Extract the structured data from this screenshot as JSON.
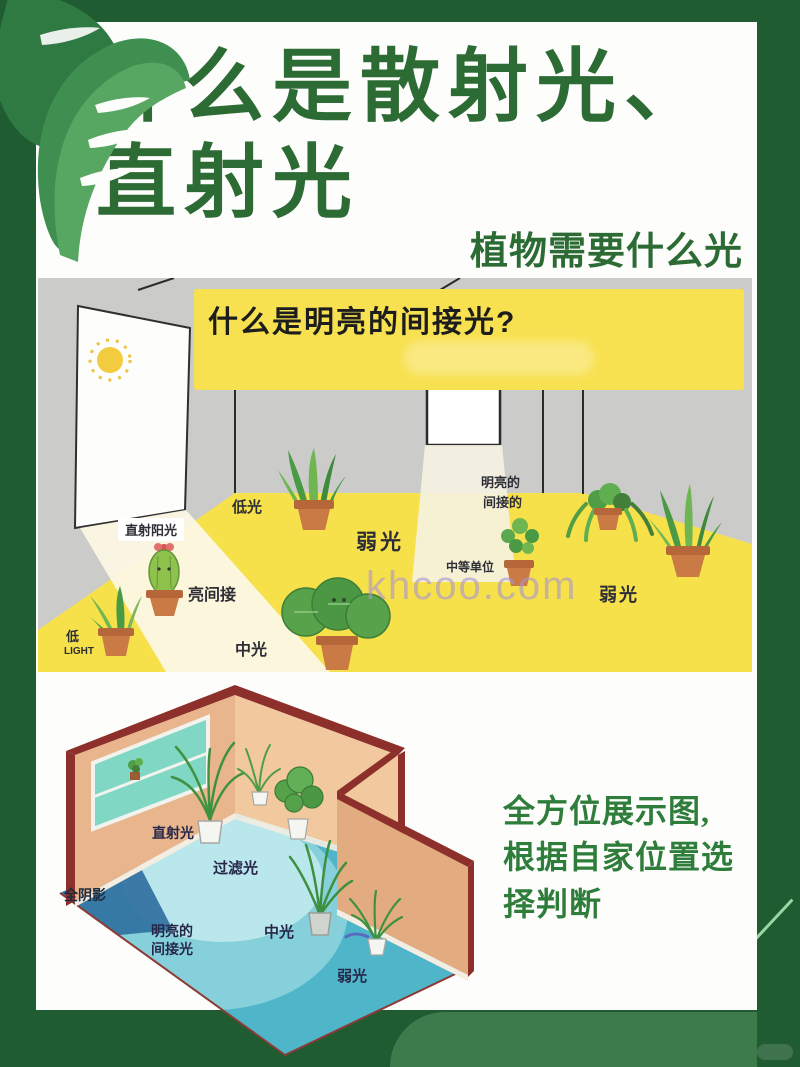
{
  "header": {
    "title_line1": "什么是散射光、",
    "title_line2": "直射光",
    "subtitle": "植物需要什么光"
  },
  "flat_room": {
    "banner_question": "什么是明亮的间接光?",
    "labels": {
      "low_light": "低光",
      "direct_sunlight": "直射阳光",
      "bright_indirect_short": "亮间接",
      "low_cn": "低",
      "low_en": "LIGHT",
      "medium_light": "中光",
      "weak_light_center": "弱光",
      "bright_line1": "明亮的",
      "bright_line2": "间接的",
      "medium_units": "中等单位",
      "weak_light_right": "弱光"
    },
    "watermark": "khcoo.com"
  },
  "iso_room": {
    "labels": {
      "direct_light": "直射光",
      "filtered_light": "过滤光",
      "full_shade": "全阴影",
      "bright_indirect_line1": "明亮的",
      "bright_indirect_line2": "间接光",
      "medium_light": "中光",
      "weak_light": "弱光"
    }
  },
  "caption": {
    "line1": "全方位展示图,",
    "line2": "根据自家位置选",
    "line3": "择判断"
  },
  "colors": {
    "frame_green": "#1f5c31",
    "accent_green": "#2d6b35",
    "caption_green": "#2e7d3b",
    "banner_yellow": "#f8e150",
    "floor_yellow": "#f6e14b",
    "wall_gray": "#cbcbc9",
    "iso_wall_salmon": "#e9b58c",
    "iso_wall_edge_red": "#8d2f2b",
    "iso_floor_cyan": "#85d0db",
    "iso_shade_blue": "#30719f",
    "watermark_lavender": "#b3a3d6"
  }
}
